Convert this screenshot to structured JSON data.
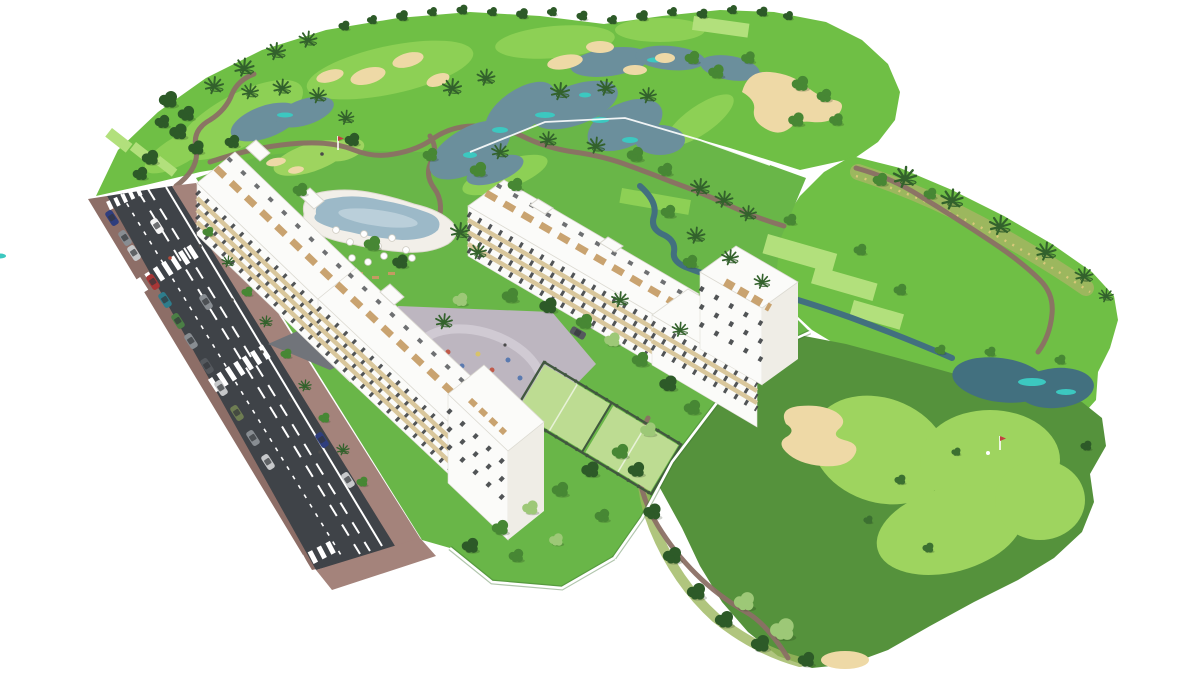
{
  "scene": {
    "type": "3d-aerial-architectural-render",
    "subject": "Golf resort residential development: white apartment blocks along an access road beside a landscaped golf course",
    "elements": [
      "golf-course",
      "lakes",
      "stream",
      "sand-bunkers",
      "putting-greens",
      "tee-boxes",
      "cart-paths",
      "palm-trees",
      "round-trees",
      "apartment-buildings",
      "roof-terraces",
      "swimming-pool",
      "sun-umbrellas",
      "paddle-tennis-courts",
      "playground-plaza",
      "access-road",
      "lane-markings",
      "crosswalks",
      "sidewalks",
      "parked-cars",
      "golf-flags",
      "golfer",
      "golf-cart",
      "perimeter-walls"
    ]
  },
  "colors": {
    "white": "#ffffff",
    "grassBright": "#6fbf45",
    "grassGarden": "#69b648",
    "grassOlive": "#55923c",
    "fairwayLight": "#8dd055",
    "puttingGreen": "#9ed45f",
    "teeGreen": "#b2e07c",
    "roughScrub": "#9cb75e",
    "scrubSpeckle": "#d8c979",
    "sand": "#eed9a6",
    "waterDark": "#42707f",
    "waterMid": "#6b8f9c",
    "waterTeal": "#3cc8c0",
    "poolWater": "#9cb9c8",
    "poolLight": "#c2d5de",
    "poolDeck": "#f2efe9",
    "deckRim": "#ddd9cf",
    "pathMauve": "#8b7065",
    "roadDark": "#3f4348",
    "sidewalkMauve": "#a4837b",
    "sidewalkDark": "#8d6e67",
    "driveGray": "#71747a",
    "plazaGray": "#bdb6c0",
    "plazaLight": "#d2ccd5",
    "bldWhite": "#fbfbf9",
    "bldShade": "#e3e1da",
    "bldSide": "#efede6",
    "balconyTan": "#d9c79c",
    "woodTan": "#c49a62",
    "winDark": "#33363a",
    "courtGreen": "#bddc92",
    "courtLine": "#e8f2d8",
    "fenceDark": "#41583f",
    "treeDark": "#2d5a28",
    "treeMid": "#478734",
    "treeLight": "#9dc877",
    "shadowGreen": "#3c7031",
    "palmDark": "#33622c",
    "trunkBrown": "#8a6a4a",
    "flagRed": "#c24040",
    "personDark": "#4a4a4a",
    "personRed": "#b34a3a",
    "carNavy": "#2f3e7e",
    "carGray": "#888d92",
    "carSilver": "#c6c8ca",
    "carWhite": "#f4f4f4",
    "carRed": "#a83636",
    "carTeal": "#2e7d8c",
    "carGreen": "#4b7f45",
    "carDark": "#55595e",
    "carOlive": "#6e7d52"
  }
}
